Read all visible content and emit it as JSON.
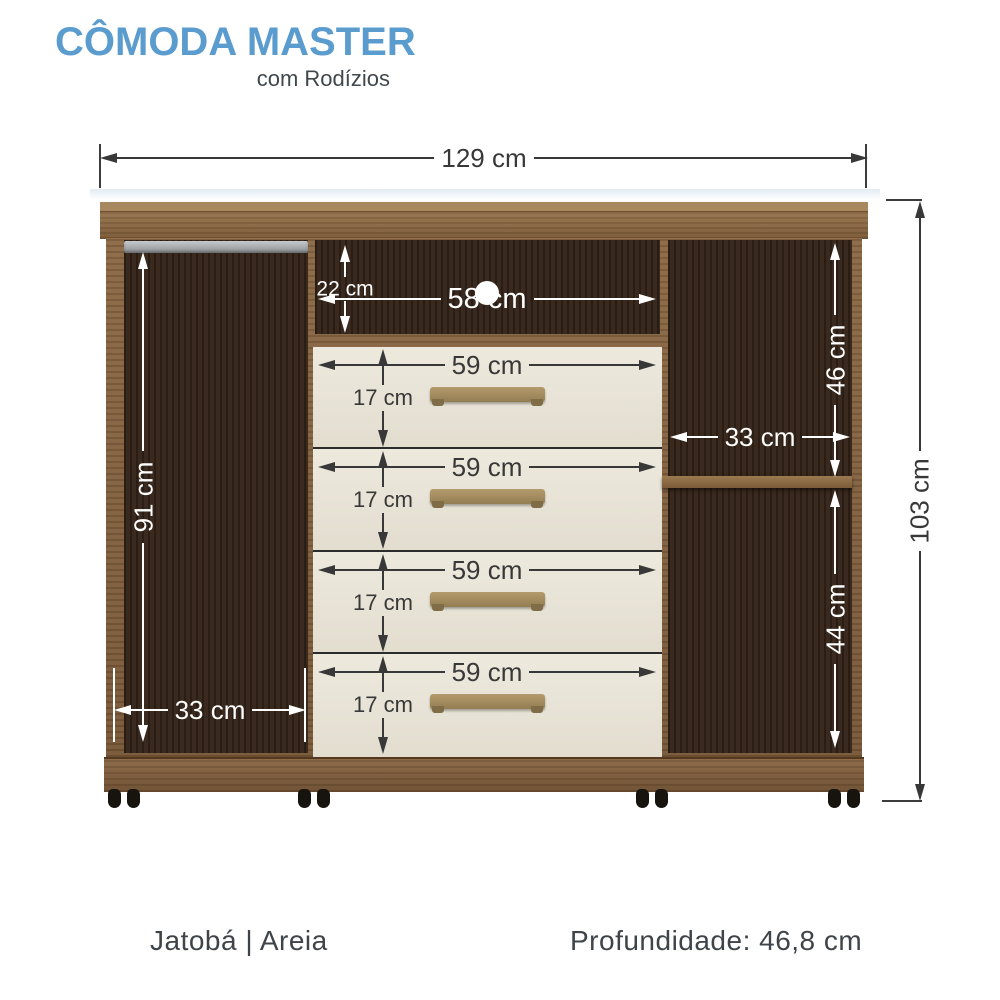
{
  "header": {
    "title": "CÔMODA MASTER",
    "subtitle": "com Rodízios"
  },
  "dimensions": {
    "total_width": "129 cm",
    "total_height": "103 cm",
    "left_compartment_height": "91 cm",
    "left_compartment_width": "33 cm",
    "niche_height": "22 cm",
    "niche_width": "58 cm",
    "right_top_compartment_height": "46 cm",
    "right_compartment_width": "33 cm",
    "right_bottom_compartment_height": "44 cm"
  },
  "drawers": [
    {
      "width": "59 cm",
      "height": "17 cm"
    },
    {
      "width": "59 cm",
      "height": "17 cm"
    },
    {
      "width": "59 cm",
      "height": "17 cm"
    },
    {
      "width": "59 cm",
      "height": "17 cm"
    }
  ],
  "footer": {
    "finish": "Jatobá | Areia",
    "depth": "Profundidade: 46,8 cm"
  },
  "colors": {
    "title_blue": "#5b9ccf",
    "subtitle_gray": "#41484d",
    "frame_wood": "#7c5a39",
    "interior_wood": "#362519",
    "drawer_front": "#e9e5d9",
    "handle_bronze": "#a08a5f",
    "dimension_dark": "#383838",
    "dimension_light": "#ffffff"
  }
}
